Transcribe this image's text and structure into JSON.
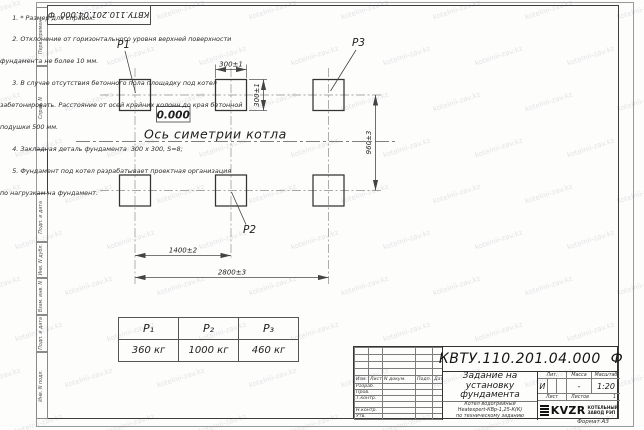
{
  "page": {
    "watermark": "kotelnii-zav.kz",
    "format_label": "Формат А3",
    "stamp_doc_number": "КВТУ.110.201.04.000  Ф"
  },
  "colors": {
    "ink": "#1f1f1f",
    "line": "#4a4a4a",
    "logo": "#111111"
  },
  "margin_labels": [
    "Перв. примен.",
    "Справ. N",
    "Подп. и дата",
    "Инв. N дубл.",
    "Взам. инв. N",
    "Подп. и дата",
    "Инв. N подл."
  ],
  "drawing": {
    "point_labels": {
      "p1": "P1",
      "p2": "P2",
      "p3": "P3"
    },
    "elevation": "0.000",
    "axis_label": "Ось симетрии котла",
    "dims": {
      "w300": "300±1",
      "h300": "300±1",
      "v960": "960±3",
      "h1400": "1400±2",
      "h2800": "2800±3"
    }
  },
  "notes": {
    "lines": [
      "      1. * Размер для справок.",
      "      2. Отклонение от горизонтального уровня верхней поверхности",
      "фундамента не более 10 мм.",
      "      3. В случае отсутствия бетонного пола площадку под котел",
      "забетонировать. Расстояние от осей крайних колонн до края бетонной",
      "подушки 500 мм.",
      "      4. Закладная деталь фундамента  300 х 300, S=8;",
      "      5. Фундамент под котел разрабатывает проектная организация",
      "по нагрузкам на фундамент."
    ]
  },
  "load_table": {
    "headers": [
      "P₁",
      "P₂",
      "P₃"
    ],
    "values": [
      "360 кг",
      "1000 кг",
      "460 кг"
    ]
  },
  "title_block": {
    "doc_number": "КВТУ.110.201.04.000  Ф",
    "title_lines": [
      "Задание на",
      "установку",
      "фундамента"
    ],
    "product_lines": [
      "Котел водогрейный",
      "Heatexpert-КВр-1,25-К(К)",
      "по техническому заданию"
    ],
    "cols": {
      "izm": "Изм.",
      "list": "Лист",
      "ndoc": "N докум.",
      "podp": "Подп.",
      "data": "Дата"
    },
    "rows": [
      "Разраб.",
      "Пров.",
      "Т.контр.",
      "",
      "Н.контр.",
      "Утв."
    ],
    "lit_label": "Лит.",
    "massa_label": "Масса",
    "masshtab_label": "Масштаб",
    "lit_value": "И",
    "massa_value": "-",
    "masshtab_value": "1:20",
    "list_label": "Лист",
    "listov_label": "Листов",
    "listov_value": "1",
    "company": {
      "logo_text": "KVZR",
      "name_line1": "КОТЕЛЬНЫЙ",
      "name_line2": "ЗАВОД РЭП"
    }
  }
}
